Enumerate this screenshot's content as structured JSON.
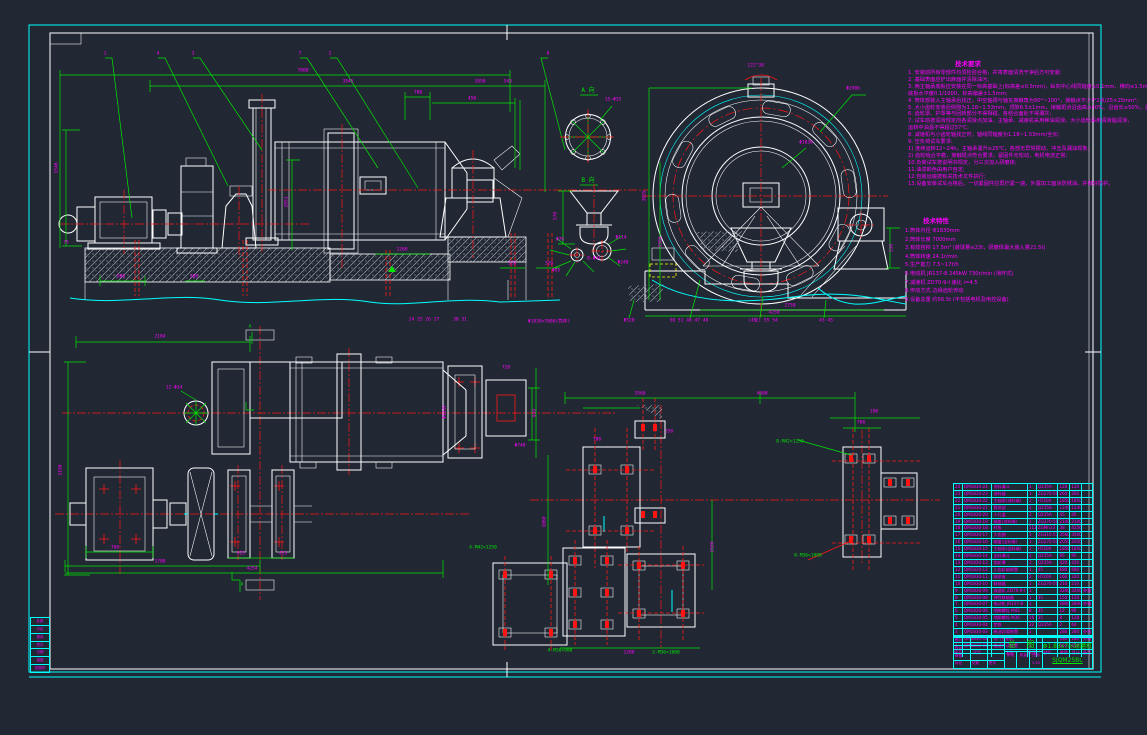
{
  "colors": {
    "background": "#212834",
    "green": "#00e600",
    "magenta": "#ff00ff",
    "red": "#ff1414",
    "cyan": "#00ffff",
    "white": "#ffffff",
    "yellow": "#ffff00"
  },
  "tech_notes": {
    "title": "技术要求",
    "lines": [
      "1. 安装前所有零部件均须检验合格，并将表面清洗干净后方可安装;",
      "2. 基础表面应铲出麻面并清除油污;",
      "3. 两主轴承底板应安装在同一标高基础上(标高差≤0.5mm)，纵向中心线同轴度≤0.1mm、横向≤1.5mm，",
      "   底板水平度0.1/1000，标高偏差±1.5mm;",
      "4. 筒体部装入主轴承后找正，中空轴颈与轴瓦接触角为90°~100°，接触点不少于2点/25×25mm²;",
      "5. 大小齿轮安装后侧隙为1.18~1.53mm，顶隙8.5±1mm，接触斑点沿齿高≥40%、沿齿长≥50%，且分布均匀;",
      "6. 齿轮罩、护罩等与回转部分不得相碰，各结合面处不得漏灰;",
      "7. 试车前按润滑规定向各润滑点加油，主轴承、减速机采用稀油润滑，大小齿轮采用润滑脂润滑，",
      "   运转中油温不得超过57℃;",
      "8. 减速机与小齿轮轴找正时，轴线同轴度为1.18~1.53mm/全长;",
      "9. 空负荷试车要求:",
      "   1) 连续运转12~24h，主轴承温升≤25℃，各部无异常振动、冲击及漏油现象;",
      "   2) 齿轮啮合平稳，接触斑点符合要求，紧固件无松动，电机电流正常;",
      "10.负荷试车按说明书规定，分三次加入研磨体;",
      "11.油漆颜色由用户自定;",
      "12.包装运输按有关技术文件执行;",
      "13.设备安装试车合格后，一切紧固件应再拧紧一遍，外露加工面涂防锈油，并做好防护。"
    ]
  },
  "main_params": {
    "title": "技术特性",
    "lines": [
      "1.筒体内径 Φ1830mm",
      "2.筒体长度 7000mm",
      "3.有效容积 17.5m³ (装球量≤23t，研磨体最大装入量21.5t)",
      "4.筒体转速 24.1r/min",
      "5.生产能力 7.5~17t/h",
      "6.电动机 JR137-8  245kW  730r/min  (滑环式)",
      "7.减速机 ZD70-9-Ⅰ  速比 i=4.5",
      "8.传动方式 边缘齿轮传动",
      "9.设备总重 约56.5t (不包括电机及电控设备)"
    ]
  },
  "dims": [
    [
      105,
      55,
      "1"
    ],
    [
      158,
      55,
      "4"
    ],
    [
      193,
      55,
      "3"
    ],
    [
      300,
      55,
      "7"
    ],
    [
      330,
      55,
      "2"
    ],
    [
      548,
      55,
      "8"
    ],
    [
      303,
      72,
      "7000"
    ],
    [
      348,
      83,
      "3545"
    ],
    [
      480,
      83,
      "1050"
    ],
    [
      508,
      83,
      "545"
    ],
    [
      418,
      94,
      "700"
    ],
    [
      472,
      100,
      "450"
    ],
    [
      58,
      168,
      "1546",
      "r"
    ],
    [
      288,
      202,
      "2051",
      "r"
    ],
    [
      66,
      244,
      "75"
    ],
    [
      121,
      278,
      "900"
    ],
    [
      194,
      278,
      "500"
    ],
    [
      402,
      251,
      "1260"
    ],
    [
      512,
      265,
      "320"
    ],
    [
      549,
      265,
      "320"
    ],
    [
      424,
      321,
      "24 25 26 27"
    ],
    [
      460,
      321,
      "30 31"
    ],
    [
      549,
      323,
      "Φ1830×7000(筒体)"
    ],
    [
      588,
      91,
      "A 向",
      "g6"
    ],
    [
      613,
      101,
      "15-Φ35"
    ],
    [
      588,
      181,
      "B 向",
      "g6"
    ],
    [
      557,
      216,
      "570",
      "r"
    ],
    [
      594,
      260,
      "8-Φ41"
    ],
    [
      560,
      241,
      "Φ76"
    ],
    [
      556,
      272,
      "Φ95"
    ],
    [
      621,
      239,
      "Φ114"
    ],
    [
      623,
      264,
      "Φ240"
    ],
    [
      646,
      196,
      "3935",
      "r"
    ],
    [
      662,
      242,
      "1586",
      "r"
    ],
    [
      790,
      307,
      "2750"
    ],
    [
      774,
      314,
      "4250"
    ],
    [
      893,
      248,
      "530",
      "r"
    ],
    [
      853,
      90,
      "Φ2906"
    ],
    [
      806,
      144,
      "Φ1830"
    ],
    [
      757,
      67,
      "122°30′"
    ],
    [
      629,
      322,
      "Φ520"
    ],
    [
      689,
      322,
      "50 51 48 47 46"
    ],
    [
      763,
      322,
      "(4处) 55 54"
    ],
    [
      826,
      322,
      "43 45"
    ],
    [
      160,
      338,
      "2184"
    ],
    [
      115,
      549,
      "760"
    ],
    [
      160,
      563,
      "1700"
    ],
    [
      252,
      570,
      "4254"
    ],
    [
      241,
      555,
      "425"
    ],
    [
      283,
      555,
      "425"
    ],
    [
      62,
      470,
      "3100",
      "r"
    ],
    [
      446,
      412,
      "Φ1830",
      "r"
    ],
    [
      506,
      369,
      "720"
    ],
    [
      520,
      447,
      "Φ740"
    ],
    [
      174,
      389,
      "12-Φ34"
    ],
    [
      536,
      413,
      "930",
      "r"
    ],
    [
      250,
      328,
      "A",
      "g"
    ],
    [
      242,
      586,
      "A",
      "g"
    ],
    [
      640,
      395,
      "3560"
    ],
    [
      762,
      395,
      "4600"
    ],
    [
      861,
      424,
      "760"
    ],
    [
      874,
      413,
      "190"
    ],
    [
      546,
      522,
      "1060",
      "r"
    ],
    [
      714,
      547,
      "1500",
      "r"
    ],
    [
      629,
      654,
      "1200"
    ],
    [
      597,
      441,
      "700"
    ],
    [
      669,
      433,
      "350"
    ],
    [
      790,
      443,
      "8-M42×1250",
      "g"
    ],
    [
      808,
      557,
      "8-M36×1000",
      "g"
    ],
    [
      560,
      652,
      "4-M30×900",
      "g"
    ],
    [
      666,
      654,
      "2-M36×1000",
      "g"
    ],
    [
      483,
      549,
      "4-M42×1250",
      "g"
    ]
  ],
  "bom": {
    "col_widths": [
      9,
      30,
      36,
      9,
      22,
      12,
      12,
      10
    ],
    "header": [
      "序号",
      "代号",
      "名称",
      "数量",
      "材料",
      "单件",
      "总计",
      "备注"
    ],
    "rows": [
      [
        "24",
        "QM1830-24",
        "进料漏斗",
        "1",
        "Q235A",
        "120",
        "120",
        ""
      ],
      [
        "23",
        "QM1830-23",
        "进料器",
        "1",
        "ZG270-500",
        "260",
        "260",
        ""
      ],
      [
        "22",
        "QM1830-22",
        "主轴承(进料端)",
        "1",
        "HT200",
        "1850",
        "1850",
        ""
      ],
      [
        "21",
        "QM1830-21",
        "筒体部",
        "1",
        "Q235B",
        "12400",
        "12400",
        ""
      ],
      [
        "20",
        "QM1830-20",
        "人孔盖",
        "1",
        "Q235A",
        "45",
        "45",
        ""
      ],
      [
        "19",
        "QM1830-19",
        "端盖(进料端)",
        "1",
        "ZG270-500",
        "2100",
        "2100",
        ""
      ],
      [
        "18",
        "QM1830-18",
        "衬板",
        "112",
        "ZGMn13",
        "38",
        "4256",
        ""
      ],
      [
        "17",
        "QM1830-17",
        "大齿圈",
        "1",
        "ZG310-570",
        "3560",
        "3560",
        ""
      ],
      [
        "16",
        "QM1830-16",
        "端盖(出料端)",
        "1",
        "ZG270-500",
        "2050",
        "2050",
        ""
      ],
      [
        "15",
        "QM1830-15",
        "主轴承(出料端)",
        "1",
        "HT200",
        "1850",
        "1850",
        ""
      ],
      [
        "14",
        "QM1830-14",
        "出料漏斗",
        "1",
        "Q235A",
        "95",
        "95",
        ""
      ],
      [
        "13",
        "QM1830-13",
        "齿轮罩",
        "1",
        "Q235A",
        "420",
        "420",
        ""
      ],
      [
        "12",
        "QM1830-12",
        "小齿轮轴装置",
        "1",
        "45",
        "680",
        "680",
        ""
      ],
      [
        "11",
        "QM1830-11",
        "轴承座",
        "2",
        "HT200",
        "160",
        "320",
        ""
      ],
      [
        "10",
        "QM1830-10",
        "联轴器",
        "1",
        "ZG270-500",
        "210",
        "210",
        ""
      ],
      [
        "9",
        "QM1830-09",
        "减速机 ZD70-9-Ⅰ",
        "1",
        "",
        "3200",
        "3200",
        "外购"
      ],
      [
        "8",
        "QM1830-08",
        "弹性联轴器",
        "1",
        "35",
        "150",
        "150",
        ""
      ],
      [
        "7",
        "QM1830-07",
        "电动机 JR137-8",
        "1",
        "",
        "2800",
        "2800",
        "外购"
      ],
      [
        "6",
        "QM1830-06",
        "地脚螺栓 M42",
        "8",
        "35",
        "12",
        "96",
        ""
      ],
      [
        "5",
        "QM1830-05",
        "地脚螺栓 M36",
        "16",
        "35",
        "8",
        "128",
        ""
      ],
      [
        "4",
        "QM1830-04",
        "垫铁",
        "32",
        "Q235A",
        "2",
        "64",
        ""
      ],
      [
        "3",
        "QM1830-03",
        "稀油润滑装置",
        "1",
        "",
        "280",
        "280",
        "外购"
      ],
      [
        "2",
        "QM1830-02",
        "电气控制柜",
        "1",
        "",
        "180",
        "180",
        "外购"
      ],
      [
        "1",
        "QM1830-01",
        "慢速传动装置",
        "1",
        "",
        "650",
        "650",
        ""
      ]
    ]
  },
  "title_block": {
    "main_label": "总 图",
    "product": "Φ1.83x7m球磨机",
    "drawing_no": "SJQM25BL",
    "left_rows": [
      [
        "设计",
        "",
        ""
      ],
      [
        "校对",
        "",
        ""
      ],
      [
        "审核",
        "",
        ""
      ],
      [
        "标记",
        "处数",
        "签字"
      ]
    ],
    "mid_row_labels": [
      "阶段",
      "质量",
      "比例"
    ],
    "mid_row_values": [
      "",
      "",
      "1:20"
    ]
  },
  "revision_strip": {
    "rows": [
      "处数",
      "分区",
      "更改",
      "签字",
      "日期",
      "描图",
      "底图号"
    ]
  }
}
